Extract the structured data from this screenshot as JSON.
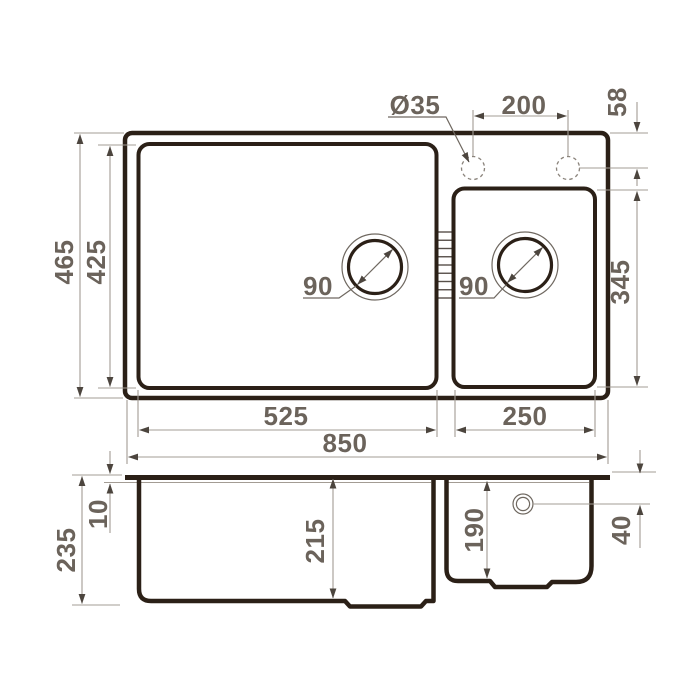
{
  "document": {
    "type": "technical dimension drawing",
    "subject": "double-bowl kitchen sink",
    "views": [
      "top view (plan)",
      "front section view"
    ],
    "units": "mm"
  },
  "colors": {
    "outline": "#2b2017",
    "dimension_line": "#a39c94",
    "arrow": "#4c453e",
    "label_text": "#6b635b",
    "background": "#ffffff"
  },
  "top_view": {
    "dimensions": {
      "faucet_hole_diameter": "Ø35",
      "faucet_hole_spacing": "200",
      "faucet_hole_offset_from_edge": "58",
      "overall_depth": "465",
      "bowl_depth": "425",
      "main_drain_diameter": "90",
      "second_drain_diameter": "90",
      "second_bowl_depth": "345",
      "main_bowl_width": "525",
      "second_bowl_width": "250",
      "overall_width": "850"
    }
  },
  "section_view": {
    "dimensions": {
      "overall_height": "235",
      "rim_thickness": "10",
      "main_bowl_inner_depth": "215",
      "second_bowl_inner_depth": "190",
      "overflow_offset_from_top": "40"
    }
  }
}
